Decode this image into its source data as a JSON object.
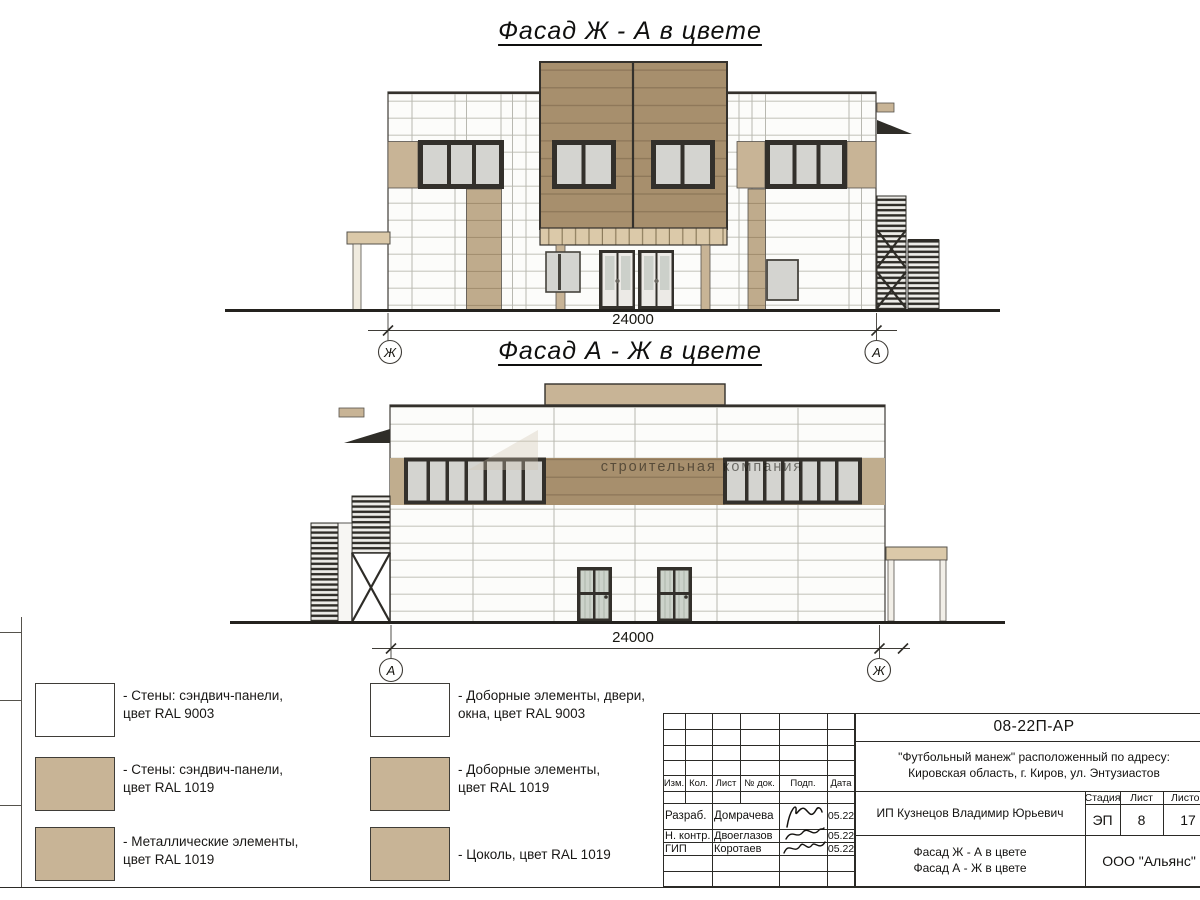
{
  "drawing": {
    "facade1": {
      "title": "Фасад Ж - А в цвете",
      "dimension": "24000",
      "axis_left": "Ж",
      "axis_right": "А"
    },
    "facade2": {
      "title": "Фасад А - Ж в цвете",
      "dimension": "24000",
      "axis_left": "А",
      "axis_right": "Ж"
    },
    "watermark": "строительная компания"
  },
  "legend": {
    "items": [
      {
        "color": "#FFFFFF",
        "label": "- Стены: сэндвич-панели,\nцвет RAL 9003"
      },
      {
        "color": "#C8B496",
        "label": "- Стены: сэндвич-панели,\nцвет RAL 1019"
      },
      {
        "color": "#C8B496",
        "label": "- Металлические элементы,\nцвет RAL 1019"
      },
      {
        "color": "#FFFFFF",
        "label": "- Доборные элементы, двери,\nокна, цвет RAL 9003"
      },
      {
        "color": "#C8B496",
        "label": "- Доборные элементы,\nцвет RAL 1019"
      },
      {
        "color": "#C8B496",
        "label": "- Цоколь, цвет RAL 1019"
      }
    ]
  },
  "title_block": {
    "doc_number": "08-22П-АР",
    "project_address_line1": "\"Футбольный манеж\" расположенный по адресу:",
    "project_address_line2": "Кировская область, г. Киров, ул. Энтузиастов",
    "columns": {
      "izm": "Изм.",
      "kol": "Кол.",
      "list": "Лист",
      "doc": "№ док.",
      "podp": "Подп.",
      "data": "Дата"
    },
    "signature_rows": [
      {
        "role": "Разраб.",
        "name": "Домрачева",
        "date": "05.22"
      },
      {
        "role": "Н. контр.",
        "name": "Двоеглазов",
        "date": "05.22"
      },
      {
        "role": "ГИП",
        "name": "Коротаев",
        "date": "05.22"
      }
    ],
    "client": "ИП Кузнецов Владимир Юрьевич",
    "sheet_name_line1": "Фасад Ж - А в цвете",
    "sheet_name_line2": "Фасад А - Ж в цвете",
    "stage_label": "Стадия",
    "stage_value": "ЭП",
    "sheet_label": "Лист",
    "sheet_value": "8",
    "sheets_label": "Листов",
    "sheets_value": "17",
    "company": "ООО \"Альянс\""
  },
  "colors": {
    "wall_white": "#FBFBF8",
    "panel_tan": "#C8B496",
    "panel_tan_dark": "#A78F6D",
    "band_tan": "#C0AD8E",
    "canopy_tan": "#DBC9A9",
    "line_dark": "#2C2A26",
    "glass": "#D4D4D0"
  }
}
